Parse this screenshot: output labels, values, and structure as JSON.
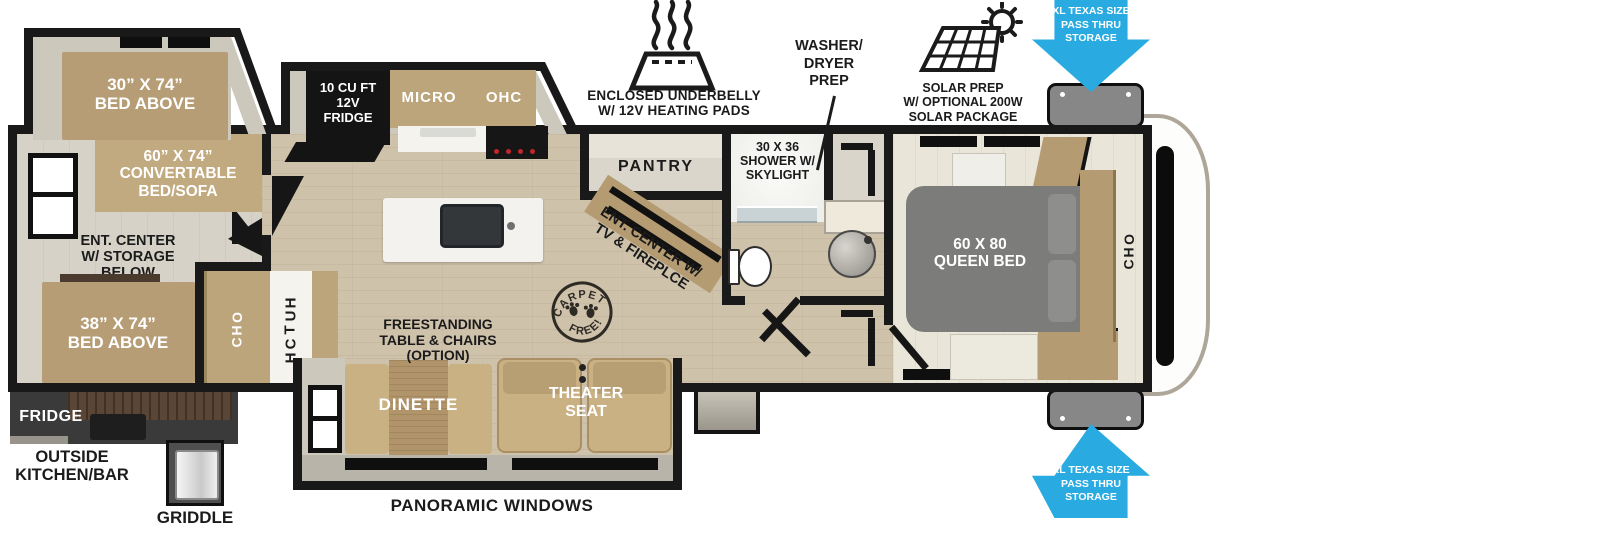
{
  "plan": {
    "bunk_slide_bed": "30” X 74”\nBED ABOVE",
    "convertible_bed": "60” X 74”\nCONVERTABLE\nBED/SOFA",
    "ent_center_storage": "ENT. CENTER\nW/ STORAGE\nBELOW",
    "bed38": "38” X 74”\nBED ABOVE",
    "ohc_left": "OHC",
    "hutch": "HUTCH",
    "fridge_12v": "10 CU FT\n12V\nFRIDGE",
    "micro": "MICRO",
    "ohc_kitchen": "OHC",
    "pantry": "PANTRY",
    "shower": "30 X 36\nSHOWER W/\nSKYLIGHT",
    "ent_center_tv": "ENT. CENTER W/\nTV & FIREPLCE",
    "freestanding": "FREESTANDING\nTABLE & CHAIRS\n(OPTION)",
    "dinette": "DINETTE",
    "theater_seat": "THEATER\nSEAT",
    "queen_bed": "60 X 80\nQUEEN BED",
    "ohc_bedroom": "OHC",
    "carpet_free_top": "CARPET",
    "carpet_free_bottom": "FREE!"
  },
  "annotations": {
    "underbelly_1": "ENCLOSED UNDERBELLY",
    "underbelly_2": "W/ 12V HEATING PADS",
    "washer_dryer": "WASHER/\nDRYER\nPREP",
    "solar": "SOLAR PREP\nW/ OPTIONAL 200W\nSOLAR PACKAGE",
    "passthru_top": "XL TEXAS SIZE\nPASS THRU\nSTORAGE",
    "passthru_bottom": "XL TEXAS SIZE\nPASS THRU\nSTORAGE",
    "panoramic_windows": "PANORAMIC WINDOWS",
    "outside_fridge": "FRIDGE",
    "outside_kitchen": "OUTSIDE\nKITCHEN/BAR",
    "griddle": "GRIDDLE"
  },
  "colors": {
    "accent_blue": "#29abe2",
    "wall": "#191919",
    "tan": "#b49b72"
  }
}
